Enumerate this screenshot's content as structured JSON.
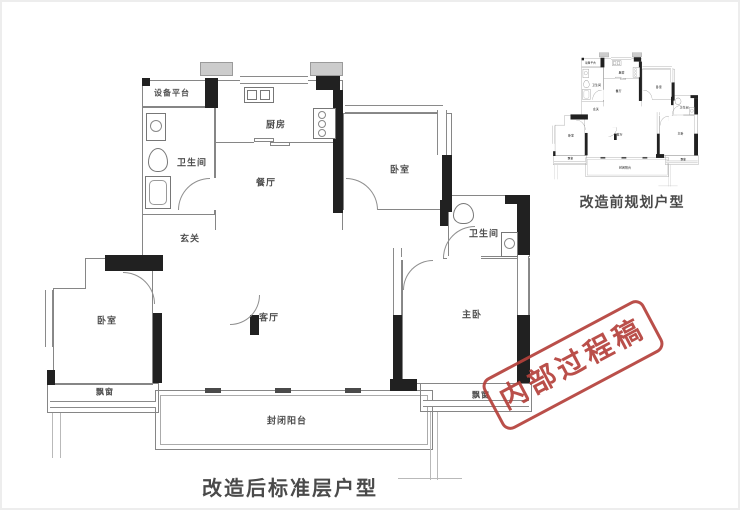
{
  "captions": {
    "main": "改造后标准层户型",
    "mini": "改造前规划户型"
  },
  "stamp": {
    "text": "内部过程稿",
    "color": "#b5413b"
  },
  "rooms": {
    "equipment_platform": "设备平台",
    "bathroom_left": "卫生间",
    "kitchen": "厨房",
    "dining": "餐厅",
    "hallway": "玄关",
    "bedroom_top": "卧室",
    "bathroom_right": "卫生间",
    "living": "客厅",
    "master_bedroom": "主卧",
    "bedroom_left": "卧室",
    "bay_window_left": "飘窗",
    "bay_window_right": "飘窗",
    "balcony": "封闭阳台"
  },
  "line_colors": {
    "wall": "#868686",
    "structure": "#212121"
  }
}
